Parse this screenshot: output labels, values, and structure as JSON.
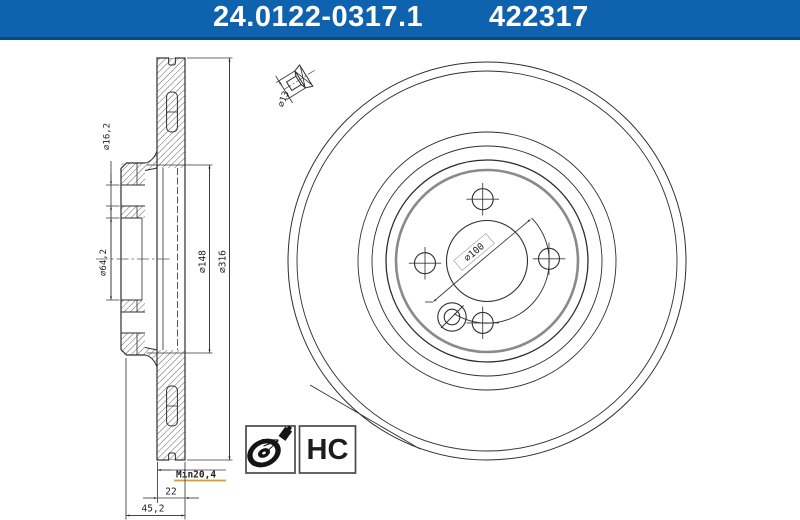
{
  "header": {
    "part_number": "24.0122-0317.1",
    "catalog_number": "422317",
    "bg_color": "#0F62AE",
    "border_color": "#0A4B84",
    "text_color": "#FFFFFF"
  },
  "side_view": {
    "dim_bolt_hole": "⌀16,2",
    "dim_bore": "⌀64,2",
    "dim_hat": "⌀148",
    "dim_outer": "⌀316",
    "dim_min_thickness": "Min20,4",
    "dim_thickness": "22",
    "dim_total_height": "45,2",
    "min_thickness_color": "#8B2B20",
    "min_underline_color": "#E09A28"
  },
  "screw_detail": {
    "dim_head": "⌀13"
  },
  "front_view": {
    "dim_bolt_circle": "⌀100"
  },
  "badges": {
    "hc_label": "HC"
  },
  "drawing": {
    "line_color": "#2E2E2E",
    "hat_ring_color": "#8A8A8A"
  }
}
